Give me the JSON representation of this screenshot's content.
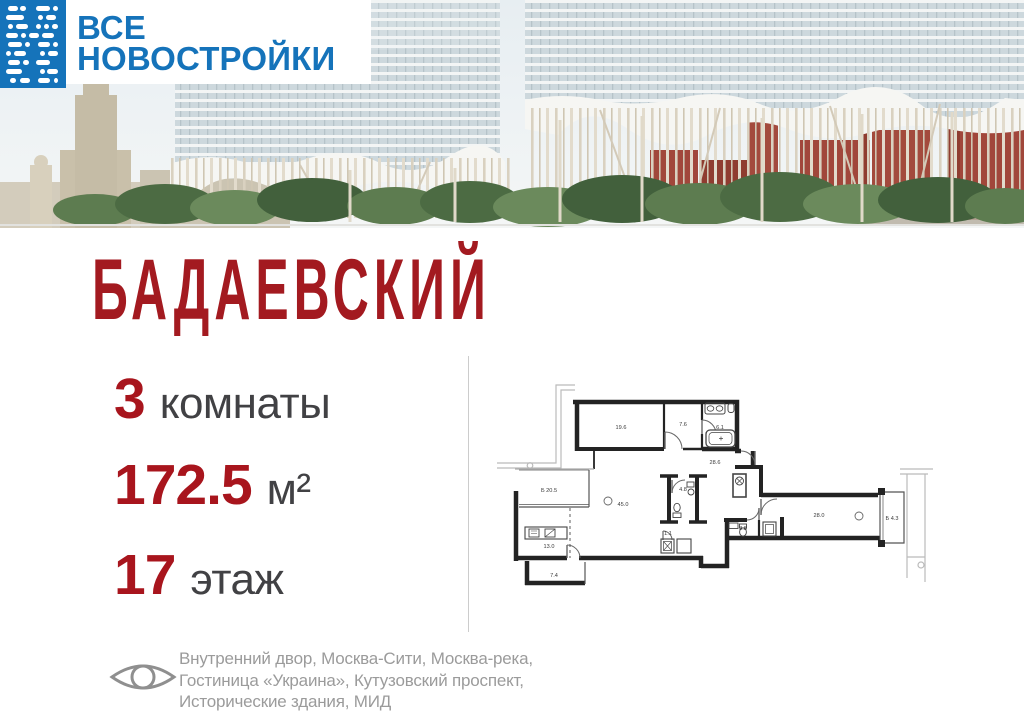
{
  "brand": {
    "name_line1": "ВСЕ",
    "name_line2": "НОВОСТРОЙКИ",
    "blue": "#1573ba"
  },
  "project": {
    "title": "БАДАЕВСКИЙ",
    "accent_red": "#a31a20"
  },
  "stats": {
    "rooms": {
      "value": "3",
      "label": "комнаты"
    },
    "area": {
      "value": "172.5",
      "label": "м²"
    },
    "floor": {
      "value": "17",
      "label": "этаж"
    }
  },
  "floor_plan": {
    "total_area": "172.5",
    "rooms": [
      {
        "label": "19.6",
        "x": 124,
        "y": 57
      },
      {
        "label": "7.6",
        "x": 186,
        "y": 54
      },
      {
        "label": "6.1",
        "x": 223,
        "y": 57
      },
      {
        "label": "28.6",
        "x": 218,
        "y": 92
      },
      {
        "label": "Б 20.5",
        "x": 52,
        "y": 120
      },
      {
        "label": "45.0",
        "x": 126,
        "y": 134
      },
      {
        "label": "4.8",
        "x": 186,
        "y": 119
      },
      {
        "label": "13.0",
        "x": 52,
        "y": 176
      },
      {
        "label": "7.4",
        "x": 57,
        "y": 205
      },
      {
        "label": "1.1",
        "x": 171,
        "y": 163
      },
      {
        "label": "3.8",
        "x": 246,
        "y": 158
      },
      {
        "label": "28.0",
        "x": 322,
        "y": 145
      },
      {
        "label": "Б 4.3",
        "x": 395,
        "y": 148
      }
    ]
  },
  "views": {
    "lines": [
      "Внутренний двор, Москва-Сити, Москва-река,",
      "Гостиница «Украина», Кутузовский проспект,",
      "Исторические здания, МИД"
    ]
  }
}
